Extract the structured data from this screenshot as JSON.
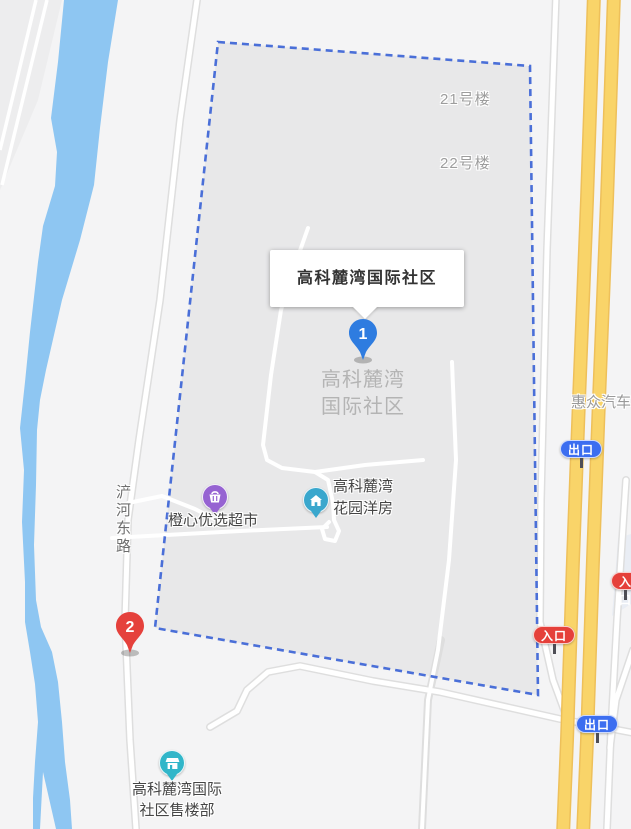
{
  "map": {
    "infobox": {
      "title": "高科麓湾国际社区"
    },
    "markers": [
      {
        "number": "1",
        "color_role": "pin-blue"
      },
      {
        "number": "2",
        "color_role": "pin-red"
      }
    ],
    "area_label": {
      "lines": [
        "高科麓湾",
        "国际社区"
      ]
    },
    "building_labels": [
      {
        "text": "21号楼"
      },
      {
        "text": "22号楼"
      }
    ],
    "road_label": "浐河东路",
    "business_label": "惠众汽车",
    "pois": [
      {
        "name": "橙心优选超市",
        "lines": [
          "橙心优选超市"
        ],
        "icon": "supermarket-icon"
      },
      {
        "name": "高科麓湾花园洋房",
        "lines": [
          "高科麓湾",
          "花园洋房"
        ],
        "icon": "house-icon"
      },
      {
        "name": "高科麓湾国际社区售楼部",
        "lines": [
          "高科麓湾国际",
          "社区售楼部"
        ],
        "icon": "storefront-icon"
      }
    ],
    "signs": [
      {
        "label": "出口",
        "type": "exit"
      },
      {
        "label": "入口",
        "type": "entrance"
      },
      {
        "label": "入口",
        "type": "entrance"
      },
      {
        "label": "出口",
        "type": "exit"
      }
    ]
  },
  "colors": {
    "boundary": "#4a6fd8",
    "community-fill": "#e8e8e9",
    "river": "#8ec6f2",
    "highway": "#f9d469",
    "highway-casing": "#eec05a",
    "pin-blue": "#2e7ce0",
    "pin-red": "#e5413c",
    "poi-purple": "#9663d2",
    "poi-cyan": "#3aa7cd",
    "poi-teal": "#31b6c9",
    "sign-blue": "#3c6ef0",
    "sign-red": "#e5403a"
  }
}
